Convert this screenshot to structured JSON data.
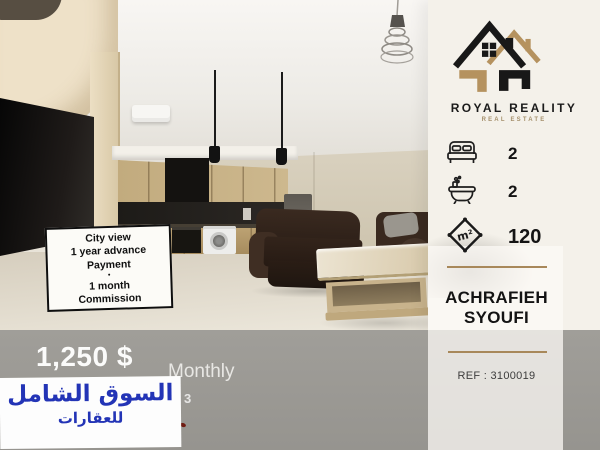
{
  "listing": {
    "photo": {
      "note": {
        "lines": [
          "City view",
          "1 year advance",
          "Payment",
          "•",
          "1 month",
          "Commission"
        ]
      }
    },
    "price_bar": {
      "price": "1,250 $",
      "period": "Monthly",
      "obscured_fragment": "3"
    },
    "watermark": {
      "line1": "السوق الشامل",
      "line2": "للعقارات"
    },
    "sidebar": {
      "brand": {
        "name": "ROYAL REALITY",
        "tagline": "REAL ESTATE"
      },
      "features": [
        {
          "label": "bedrooms",
          "value": "2"
        },
        {
          "label": "bathrooms",
          "value": "2"
        },
        {
          "label": "area",
          "value": "120",
          "unit": "m²"
        }
      ],
      "location": {
        "line1": "ACHRAFIEH",
        "line2": "SYOUFI"
      },
      "reference": "REF : 3100019"
    },
    "colors": {
      "gold": "#a8885a",
      "band_gray": "#9c9a95",
      "watermark_blue": "#2334b6",
      "sidebar_bg": "#f4f1ea"
    }
  }
}
